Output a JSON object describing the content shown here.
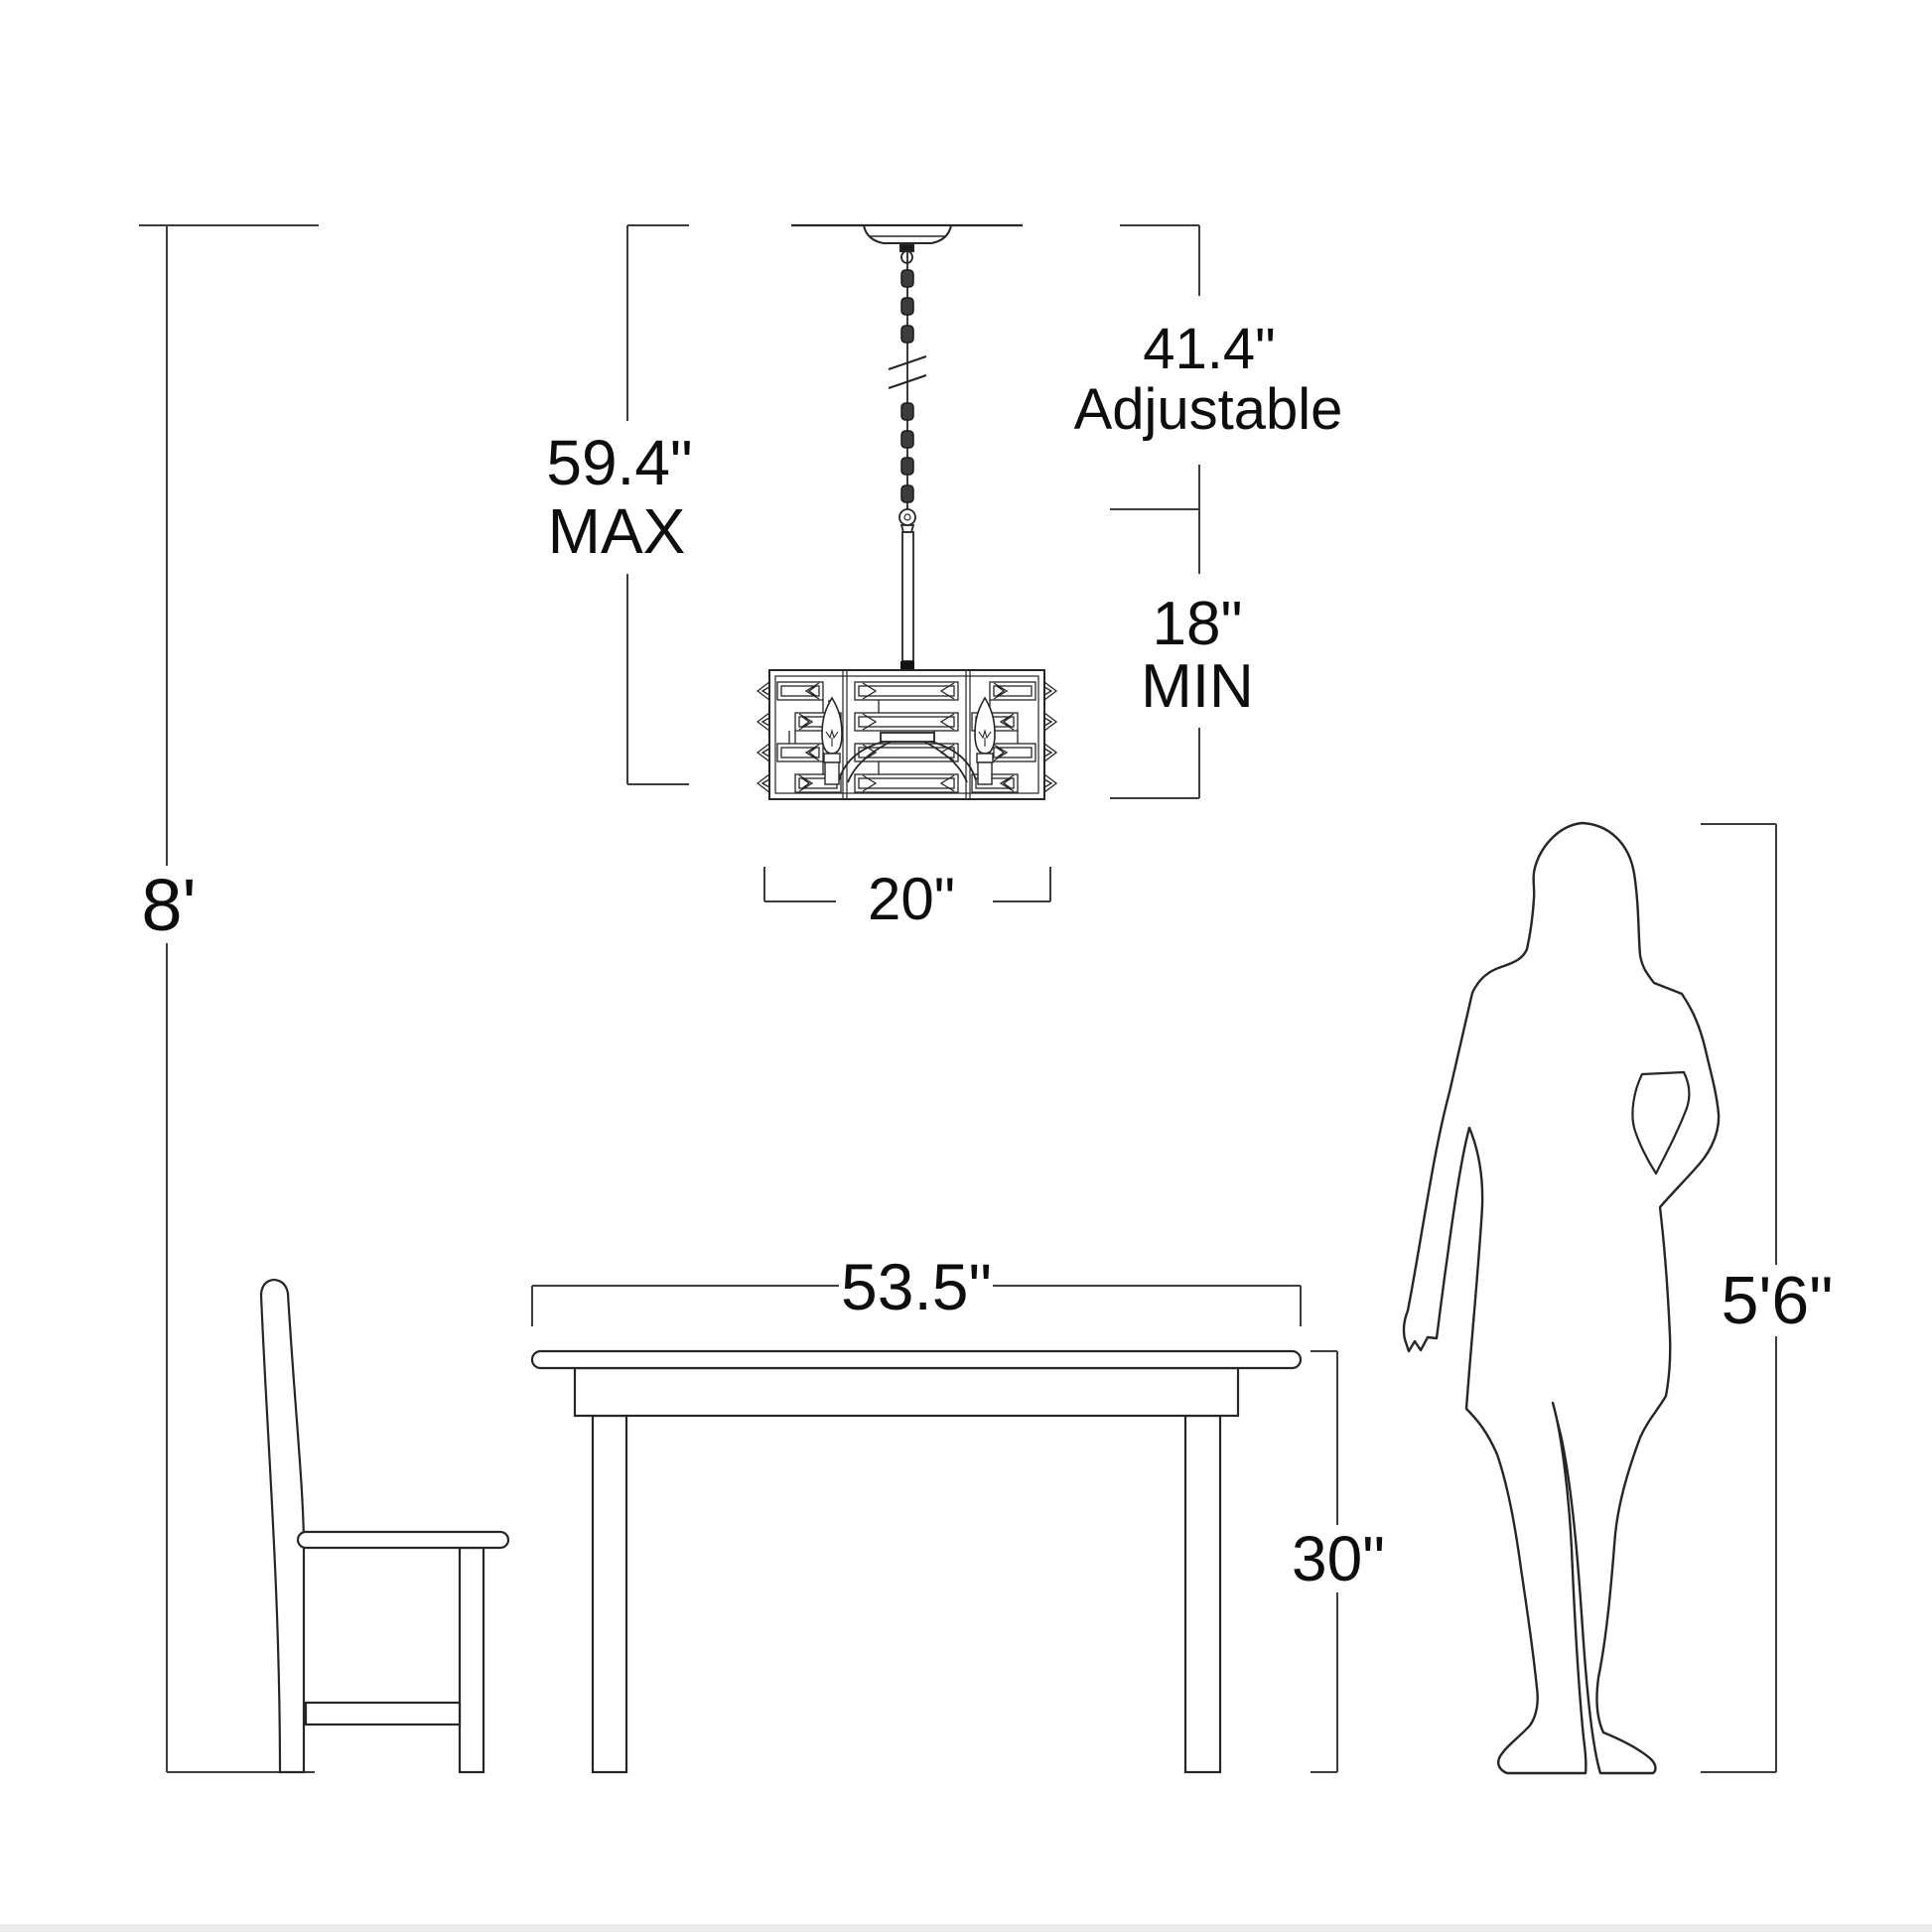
{
  "diagram": {
    "type": "chandelier-installation-dimension-diagram",
    "colors": {
      "background": "#ffffff",
      "drawing_line": "#262626",
      "dimension_line": "#3d3d3d",
      "text": "#0d0d0d",
      "bottom_strip": "#ececec"
    },
    "labels": {
      "ceiling_height": "8'",
      "max_value": "59.4\"",
      "max_qualifier": "MAX",
      "adjustable_value": "41.4\"",
      "adjustable_qualifier": "Adjustable",
      "min_value": "18\"",
      "min_qualifier": "MIN",
      "fixture_width": "20\"",
      "table_width": "53.5\"",
      "table_height": "30\"",
      "person_height": "5'6\""
    }
  }
}
